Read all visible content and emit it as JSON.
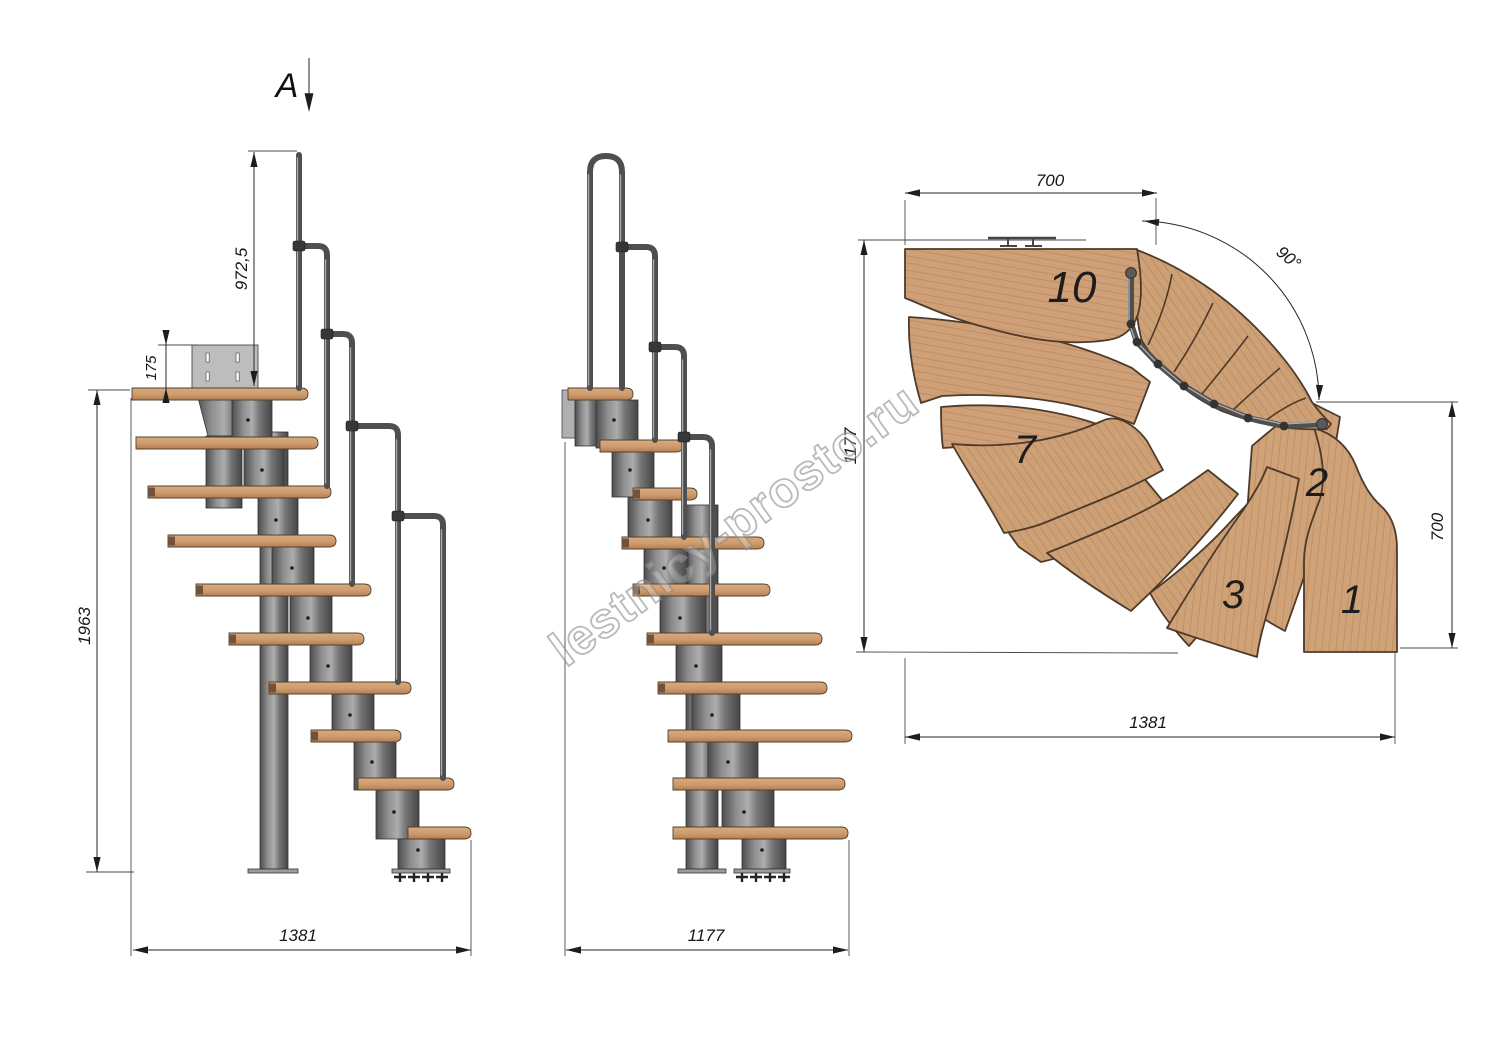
{
  "labels": {
    "section": "A"
  },
  "watermark": {
    "text": "lestnicy-prosto.ru"
  },
  "side_view": {
    "title": "side elevation",
    "dims": {
      "handrail_height": "972,5",
      "plate_height": "175",
      "total_height": "1963",
      "length": "1381"
    }
  },
  "front_view": {
    "title": "front elevation",
    "dims": {
      "width": "1177"
    }
  },
  "plan_view": {
    "title": "plan view",
    "dims": {
      "top_width": "700",
      "angle": "90°",
      "left_depth": "1177",
      "right_height": "700",
      "bottom_length": "1381"
    },
    "steps": {
      "n10": "10",
      "n7": "7",
      "n2": "2",
      "n3": "3",
      "n1": "1"
    }
  },
  "colors": {
    "wood": "#cfa077",
    "wood_dark": "#b9895f",
    "metal": "#787878",
    "metal_dark": "#3c3c3c",
    "rail": "#4f4f4f",
    "dimension_line": "#262626",
    "background": "#ffffff"
  }
}
